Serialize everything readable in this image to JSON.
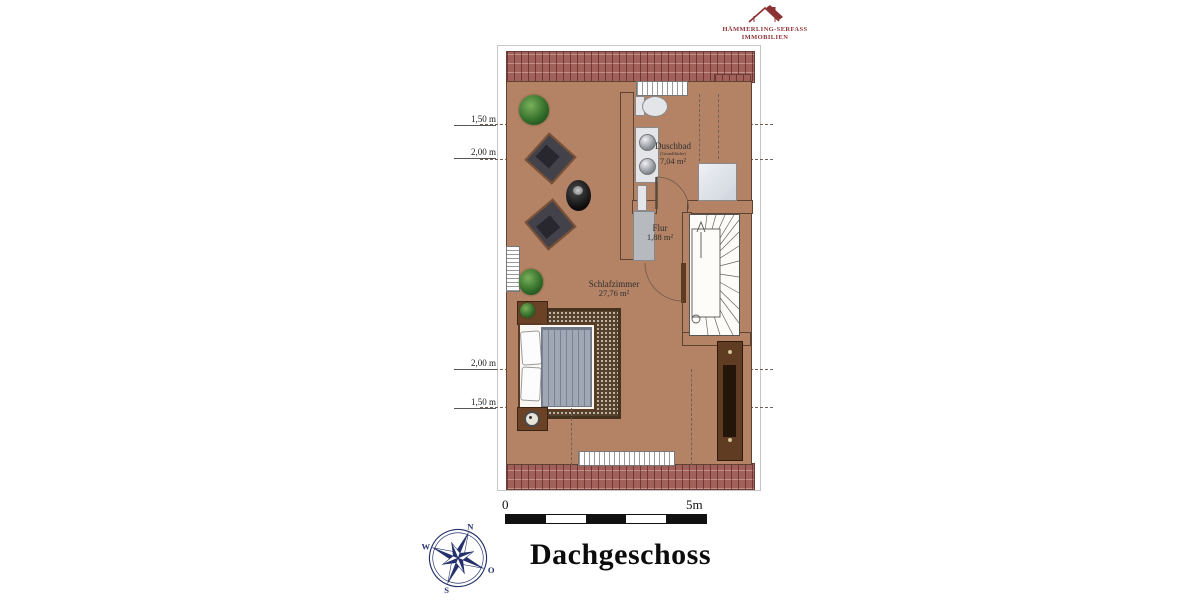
{
  "header_logo": {
    "name_line": "HÄMMERLING-SERFASS",
    "sub_line": "IMMOBILIEN"
  },
  "plan": {
    "rooms": [
      {
        "name": "Duschbad",
        "note": "(Grundfläche)",
        "area": "7,04 m²"
      },
      {
        "name": "Flur",
        "area": "1,88 m²"
      },
      {
        "name": "Schlafzimmer",
        "area": "27,76 m²"
      }
    ],
    "height_lines": [
      "1,50 m",
      "2,00 m",
      "2,00 m",
      "1,50 m"
    ]
  },
  "scale_bar": {
    "start": "0",
    "end": "5m"
  },
  "compass": {
    "n": "N",
    "e": "O",
    "s": "S",
    "w": "W"
  },
  "title": "Dachgeschoss"
}
